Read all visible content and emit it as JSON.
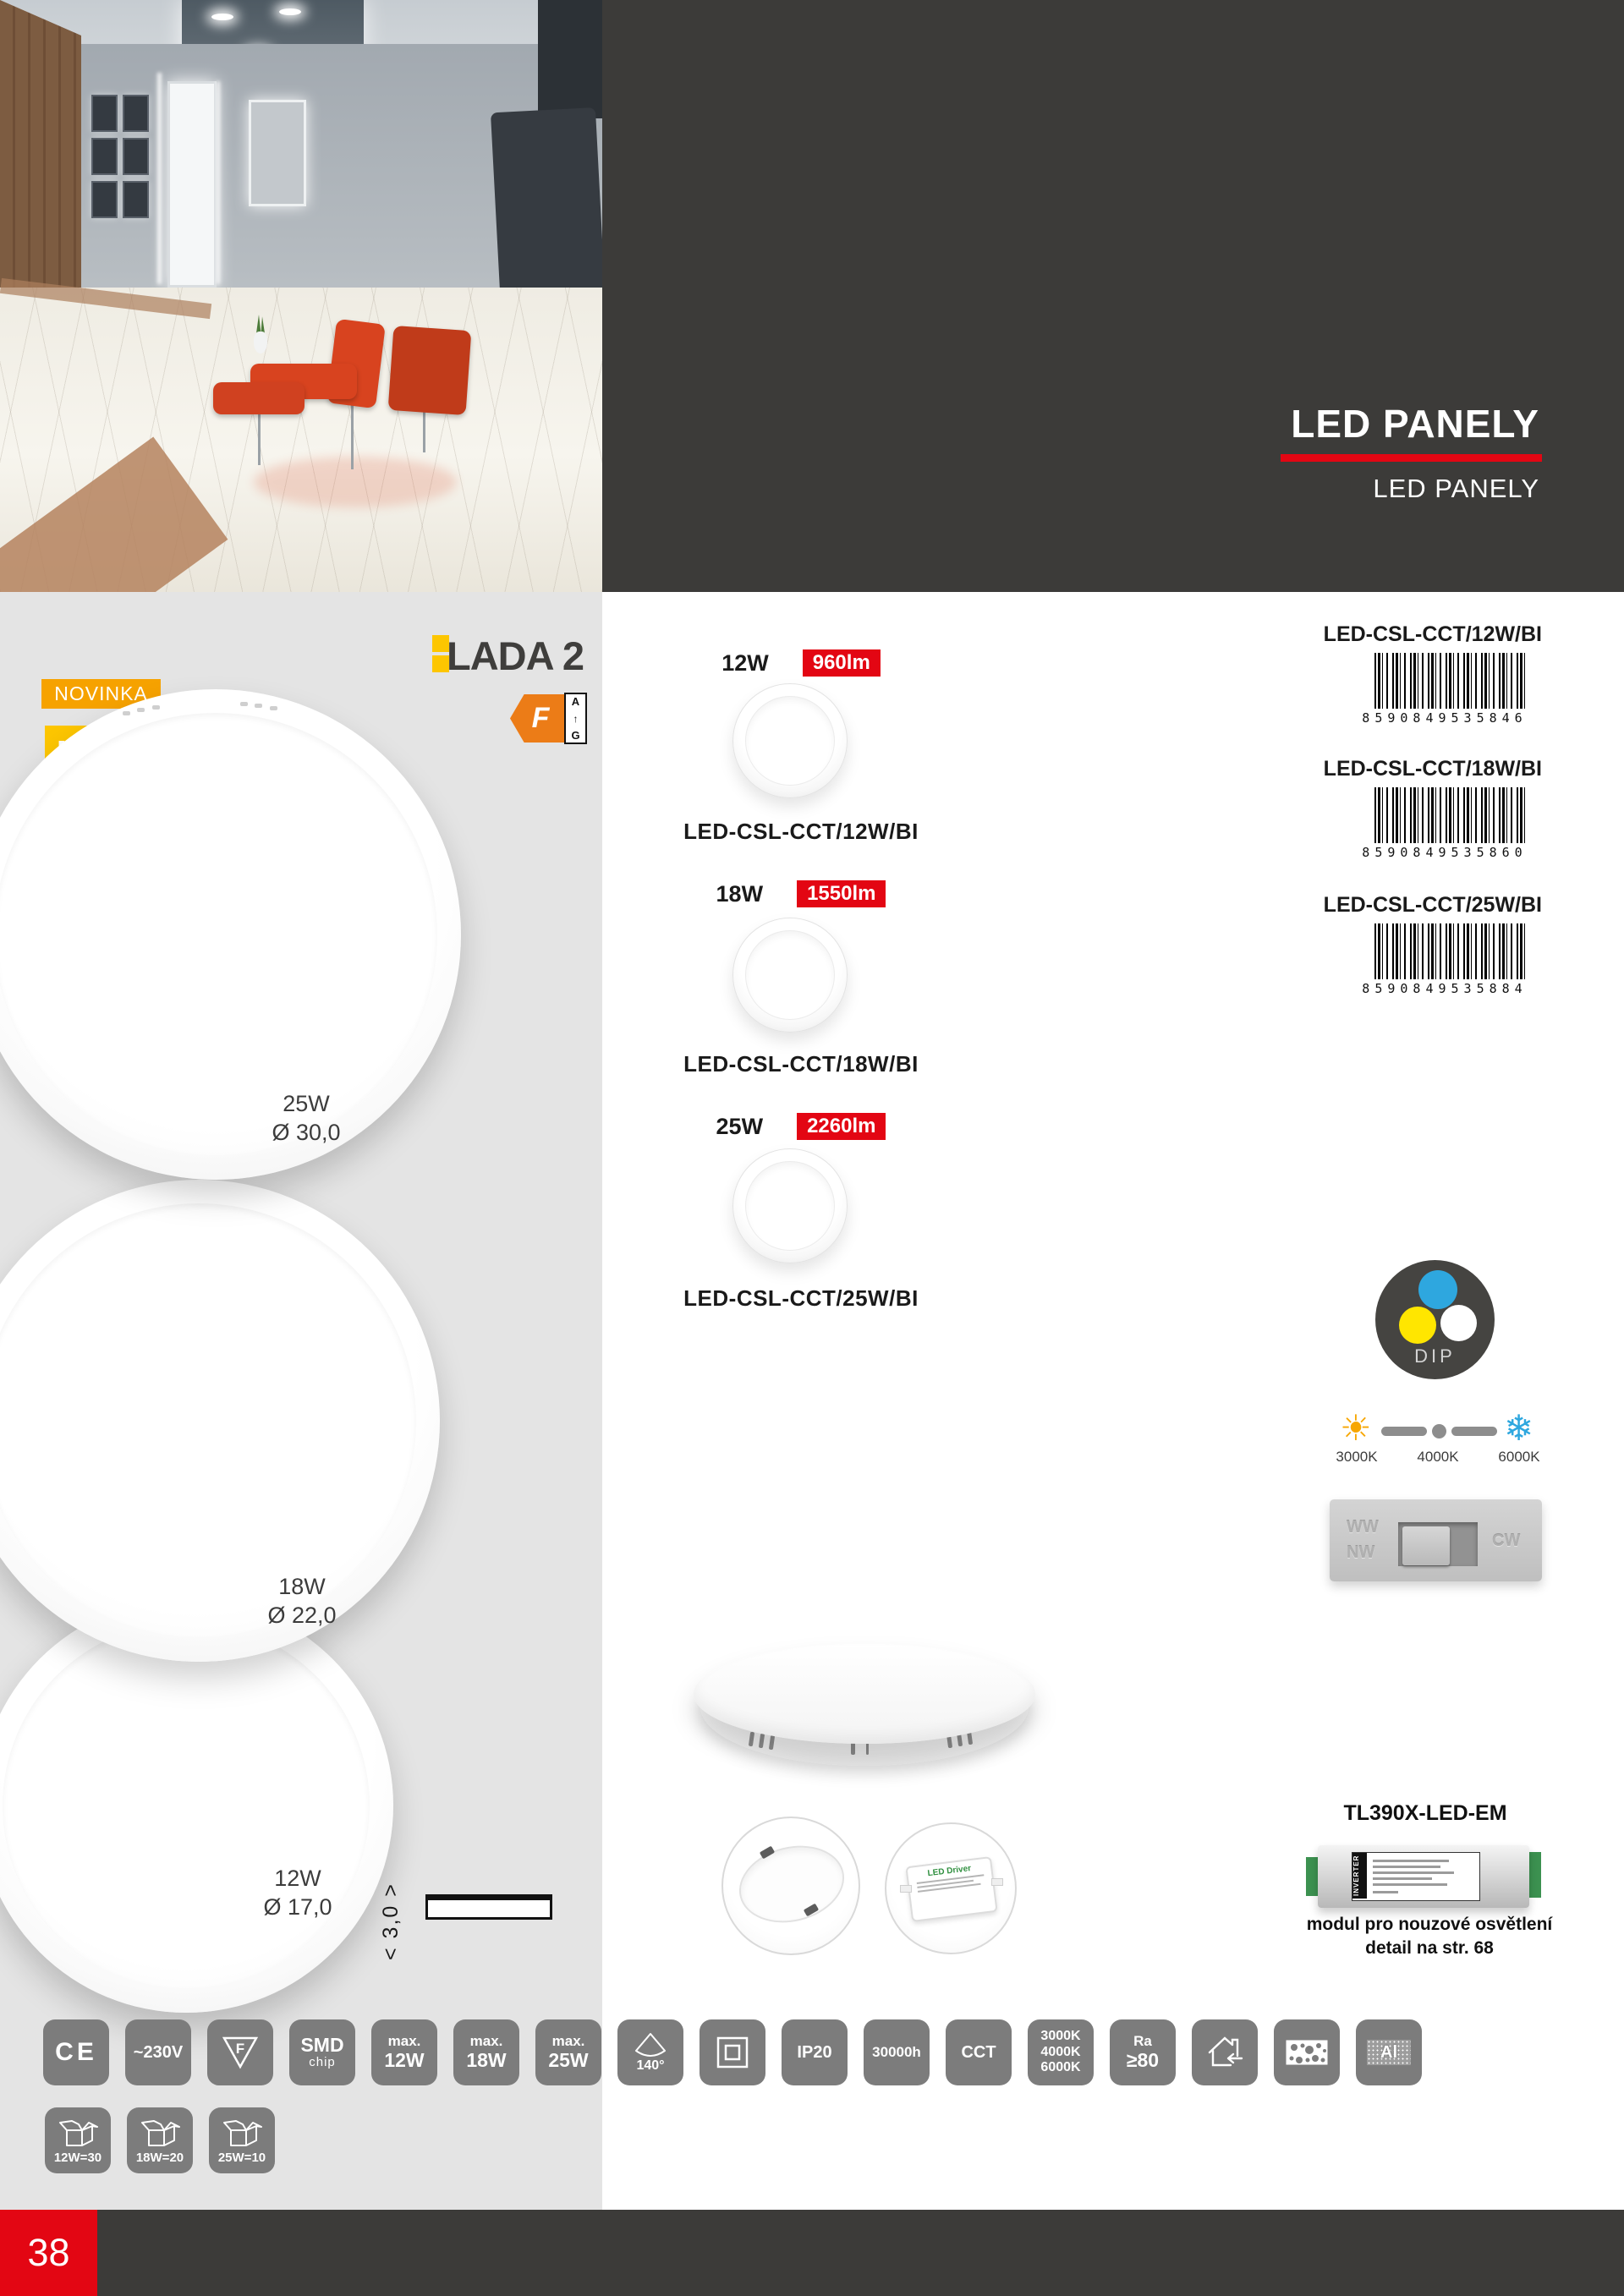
{
  "page_number": "38",
  "header": {
    "title": "LED PANELY",
    "subtitle": "LED PANELY"
  },
  "brand": {
    "new_badge": "NOVINKA",
    "led_badge": "LED",
    "series": "LADA 2",
    "energy_class": "F",
    "energy_scale_top": "A",
    "energy_scale_arrow": "↑",
    "energy_scale_bottom": "G"
  },
  "panels": [
    {
      "watt": "25W",
      "diameter": "Ø 30,0"
    },
    {
      "watt": "18W",
      "diameter": "Ø 22,0"
    },
    {
      "watt": "12W",
      "diameter": "Ø 17,0"
    }
  ],
  "profile_depth": "< 3,0 >",
  "variants": [
    {
      "watt": "12W",
      "lumens": "960lm",
      "code": "LED-CSL-CCT/12W/BI"
    },
    {
      "watt": "18W",
      "lumens": "1550lm",
      "code": "LED-CSL-CCT/18W/BI"
    },
    {
      "watt": "25W",
      "lumens": "2260lm",
      "code": "LED-CSL-CCT/25W/BI"
    }
  ],
  "barcodes": [
    {
      "code": "LED-CSL-CCT/12W/BI",
      "ean": "8590849535846"
    },
    {
      "code": "LED-CSL-CCT/18W/BI",
      "ean": "8590849535860"
    },
    {
      "code": "LED-CSL-CCT/25W/BI",
      "ean": "8590849535884"
    }
  ],
  "cct": {
    "dip": "DIP",
    "temps": [
      "3000K",
      "4000K",
      "6000K"
    ],
    "switch_ww": "WW",
    "switch_nw": "NW",
    "switch_cw": "CW"
  },
  "driver_label": "LED Driver",
  "emergency": {
    "model": "TL390X-LED-EM",
    "inverter_label": "INVERTER",
    "line1": "modul pro nouzové osvětlení",
    "line2": "detail na str. 68"
  },
  "icons_row1": [
    {
      "type": "ce",
      "name": "ce-mark-icon",
      "label": "CE"
    },
    {
      "type": "line1",
      "name": "voltage-icon",
      "label": "~230V"
    },
    {
      "type": "ftri",
      "name": "f-luminaire-icon",
      "label": "F"
    },
    {
      "type": "line2",
      "name": "smd-chip-icon",
      "top": "SMD",
      "bottom": "chip"
    },
    {
      "type": "line2",
      "name": "max-12w-icon",
      "top": "max.",
      "bottom": "12W"
    },
    {
      "type": "line2",
      "name": "max-18w-icon",
      "top": "max.",
      "bottom": "18W"
    },
    {
      "type": "line2",
      "name": "max-25w-icon",
      "top": "max.",
      "bottom": "25W"
    },
    {
      "type": "cone",
      "name": "beam-angle-icon",
      "label": "140°"
    },
    {
      "type": "class2",
      "name": "class-ii-icon"
    },
    {
      "type": "line1",
      "name": "ip20-icon",
      "label": "IP20"
    },
    {
      "type": "line1s",
      "name": "lifetime-icon",
      "label": "30000h"
    },
    {
      "type": "line1",
      "name": "cct-icon",
      "label": "CCT"
    },
    {
      "type": "line3",
      "name": "color-temp-icon",
      "lines": [
        "3000K",
        "4000K",
        "6000K"
      ]
    },
    {
      "type": "line2",
      "name": "ra-icon",
      "top": "Ra",
      "bottom": "≥80"
    },
    {
      "type": "house",
      "name": "indoor-use-icon"
    },
    {
      "type": "panel",
      "name": "mounting-panel-icon"
    },
    {
      "type": "al",
      "name": "aluminum-icon",
      "label": "Al"
    }
  ],
  "icons_row2": [
    {
      "type": "box",
      "name": "packaging-12w-icon",
      "label": "12W=30"
    },
    {
      "type": "box",
      "name": "packaging-18w-icon",
      "label": "18W=20"
    },
    {
      "type": "box",
      "name": "packaging-25w-icon",
      "label": "25W=10"
    }
  ],
  "colors": {
    "accent_red": "#e30613",
    "dark_gray": "#3c3b39",
    "icon_gray": "#7c7c7c",
    "badge_orange": "#f6a200",
    "badge_yellow": "#fdc600",
    "energy_orange": "#ec7c17",
    "cct_blue": "#2ea7df",
    "cct_yellow": "#ffe600"
  }
}
